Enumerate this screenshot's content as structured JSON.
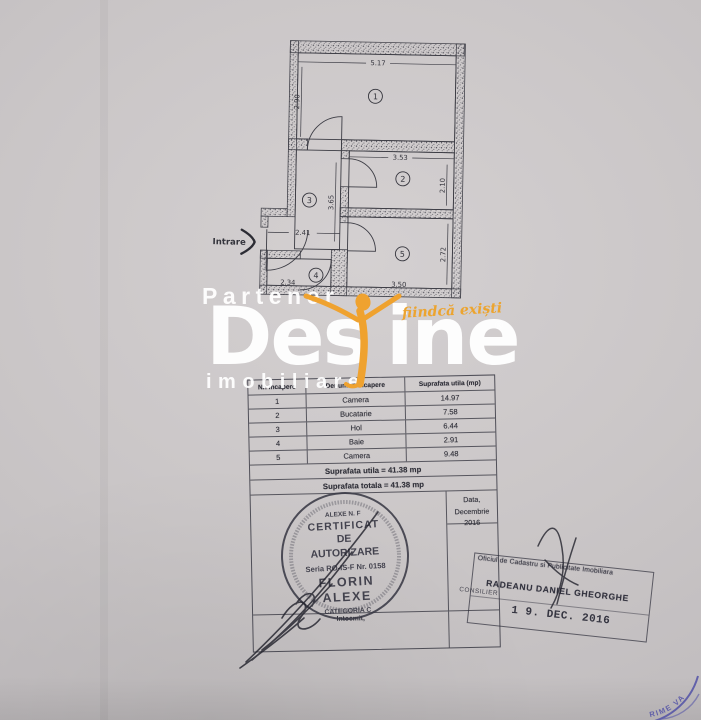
{
  "plan": {
    "entrance_label": "Intrare",
    "room_numbers": [
      "1",
      "2",
      "3",
      "4",
      "5"
    ],
    "dims": {
      "room1_w": "5.17",
      "room1_h": "2.90",
      "room2_w": "3.53",
      "room2_h": "2.10",
      "hall_h": "3.65",
      "hall_w": "2.41",
      "room5_h": "2.72",
      "room5_w": "3.50",
      "bath_w": "2.34"
    }
  },
  "table": {
    "headers": [
      "Nr. incapere",
      "Denumire incapere",
      "Suprafata utila (mp)"
    ],
    "rows": [
      {
        "nr": "1",
        "name": "Camera",
        "area": "14.97"
      },
      {
        "nr": "2",
        "name": "Bucatarie",
        "area": "7.58"
      },
      {
        "nr": "3",
        "name": "Hol",
        "area": "6.44"
      },
      {
        "nr": "4",
        "name": "Baie",
        "area": "2.91"
      },
      {
        "nr": "5",
        "name": "Camera",
        "area": "9.48"
      }
    ],
    "footer_utila": "Suprafata utila = 41.38 mp",
    "footer_totala": "Suprafata totala = 41.38 mp",
    "date_label": "Data,",
    "date_value": "Decembrie 2016",
    "prepared_label": "Intocmit,"
  },
  "round_stamp": {
    "holder_line": "ALEXE N. F",
    "line1": "CERTIFICAT",
    "line2": "DE",
    "line3": "AUTORIZARE",
    "serial": "Seria RO-IS-F Nr. 0158",
    "first_name": "FLORIN",
    "last_name": "ALEXE",
    "category": "CATEGORIA C"
  },
  "rect_stamp": {
    "office": "Oficiul de Cadastru si Publicitate Imobiliara",
    "name": "RADEANU DANIEL GHEORGHE",
    "role": "CONSILIER",
    "date": "1 9. DEC. 2016"
  },
  "corner_stamp": {
    "fragment": "RIME VA"
  },
  "watermark": {
    "partner": "Partener",
    "brand_left": "Des",
    "brand_right": "ine",
    "registered": "®",
    "tagline": "fiindcă exiști",
    "subtitle": "imobiliare",
    "orange": "#efa22f",
    "white": "#ffffff",
    "stamp_blue": "#4b4ba6"
  }
}
